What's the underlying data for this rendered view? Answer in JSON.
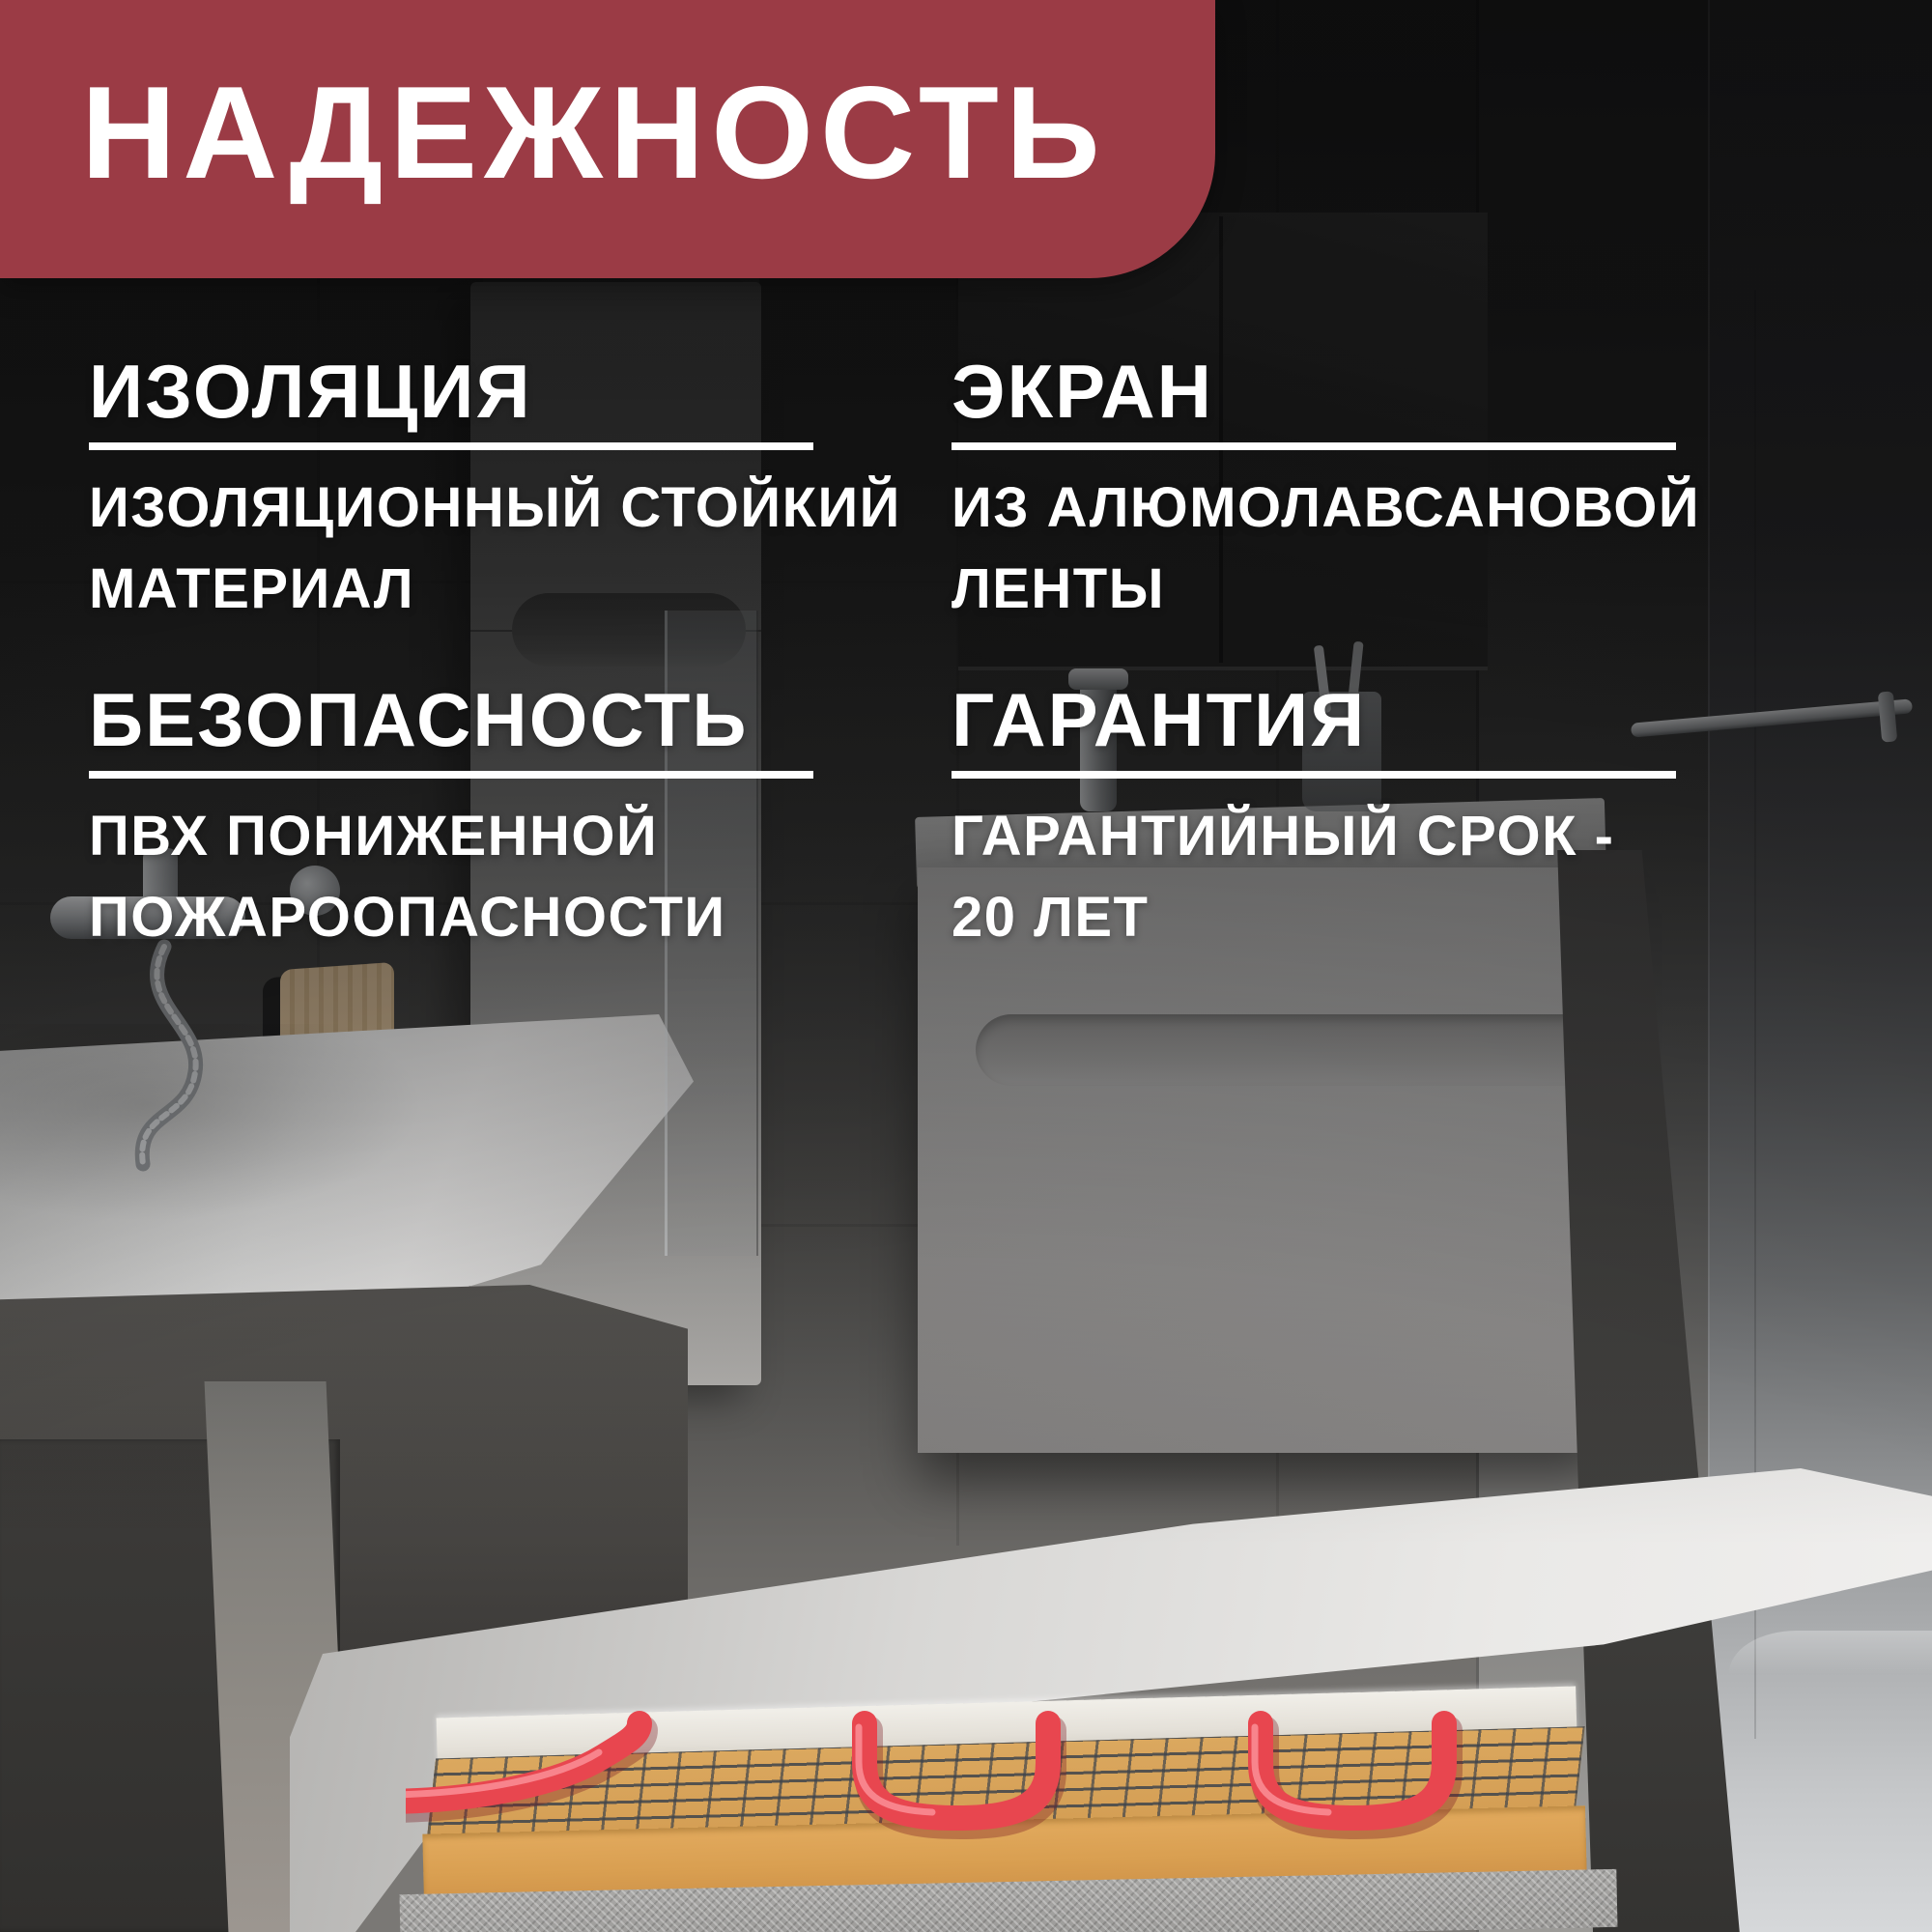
{
  "banner": {
    "title": "НАДЕЖНОСТЬ",
    "background": "#9b3b45",
    "text_color": "#ffffff"
  },
  "features": [
    {
      "heading": "ИЗОЛЯЦИЯ",
      "body_line1": "ИЗОЛЯЦИОННЫЙ СТОЙКИЙ",
      "body_line2": "МАТЕРИАЛ"
    },
    {
      "heading": "ЭКРАН",
      "body_line1": "ИЗ АЛЮМОЛАВСАНОВОЙ",
      "body_line2": "ЛЕНТЫ"
    },
    {
      "heading": "БЕЗОПАСНОСТЬ",
      "body_line1": "ПВХ ПОНИЖЕННОЙ",
      "body_line2": "ПОЖАРООПАСНОСТИ"
    },
    {
      "heading": "ГАРАНТИЯ",
      "body_line1": "ГАРАНТИЙНЫЙ СРОК -",
      "body_line2": "20 ЛЕТ"
    }
  ],
  "colors": {
    "banner_red": "#9b3b45",
    "text_white": "#ffffff",
    "divider_white": "#ffffff",
    "heating_cable_red": "#e8464f",
    "mat_mesh_tan": "#d9a55d",
    "adhesive_tan": "#dfa75c",
    "concrete_gray": "#a4a4a2"
  }
}
